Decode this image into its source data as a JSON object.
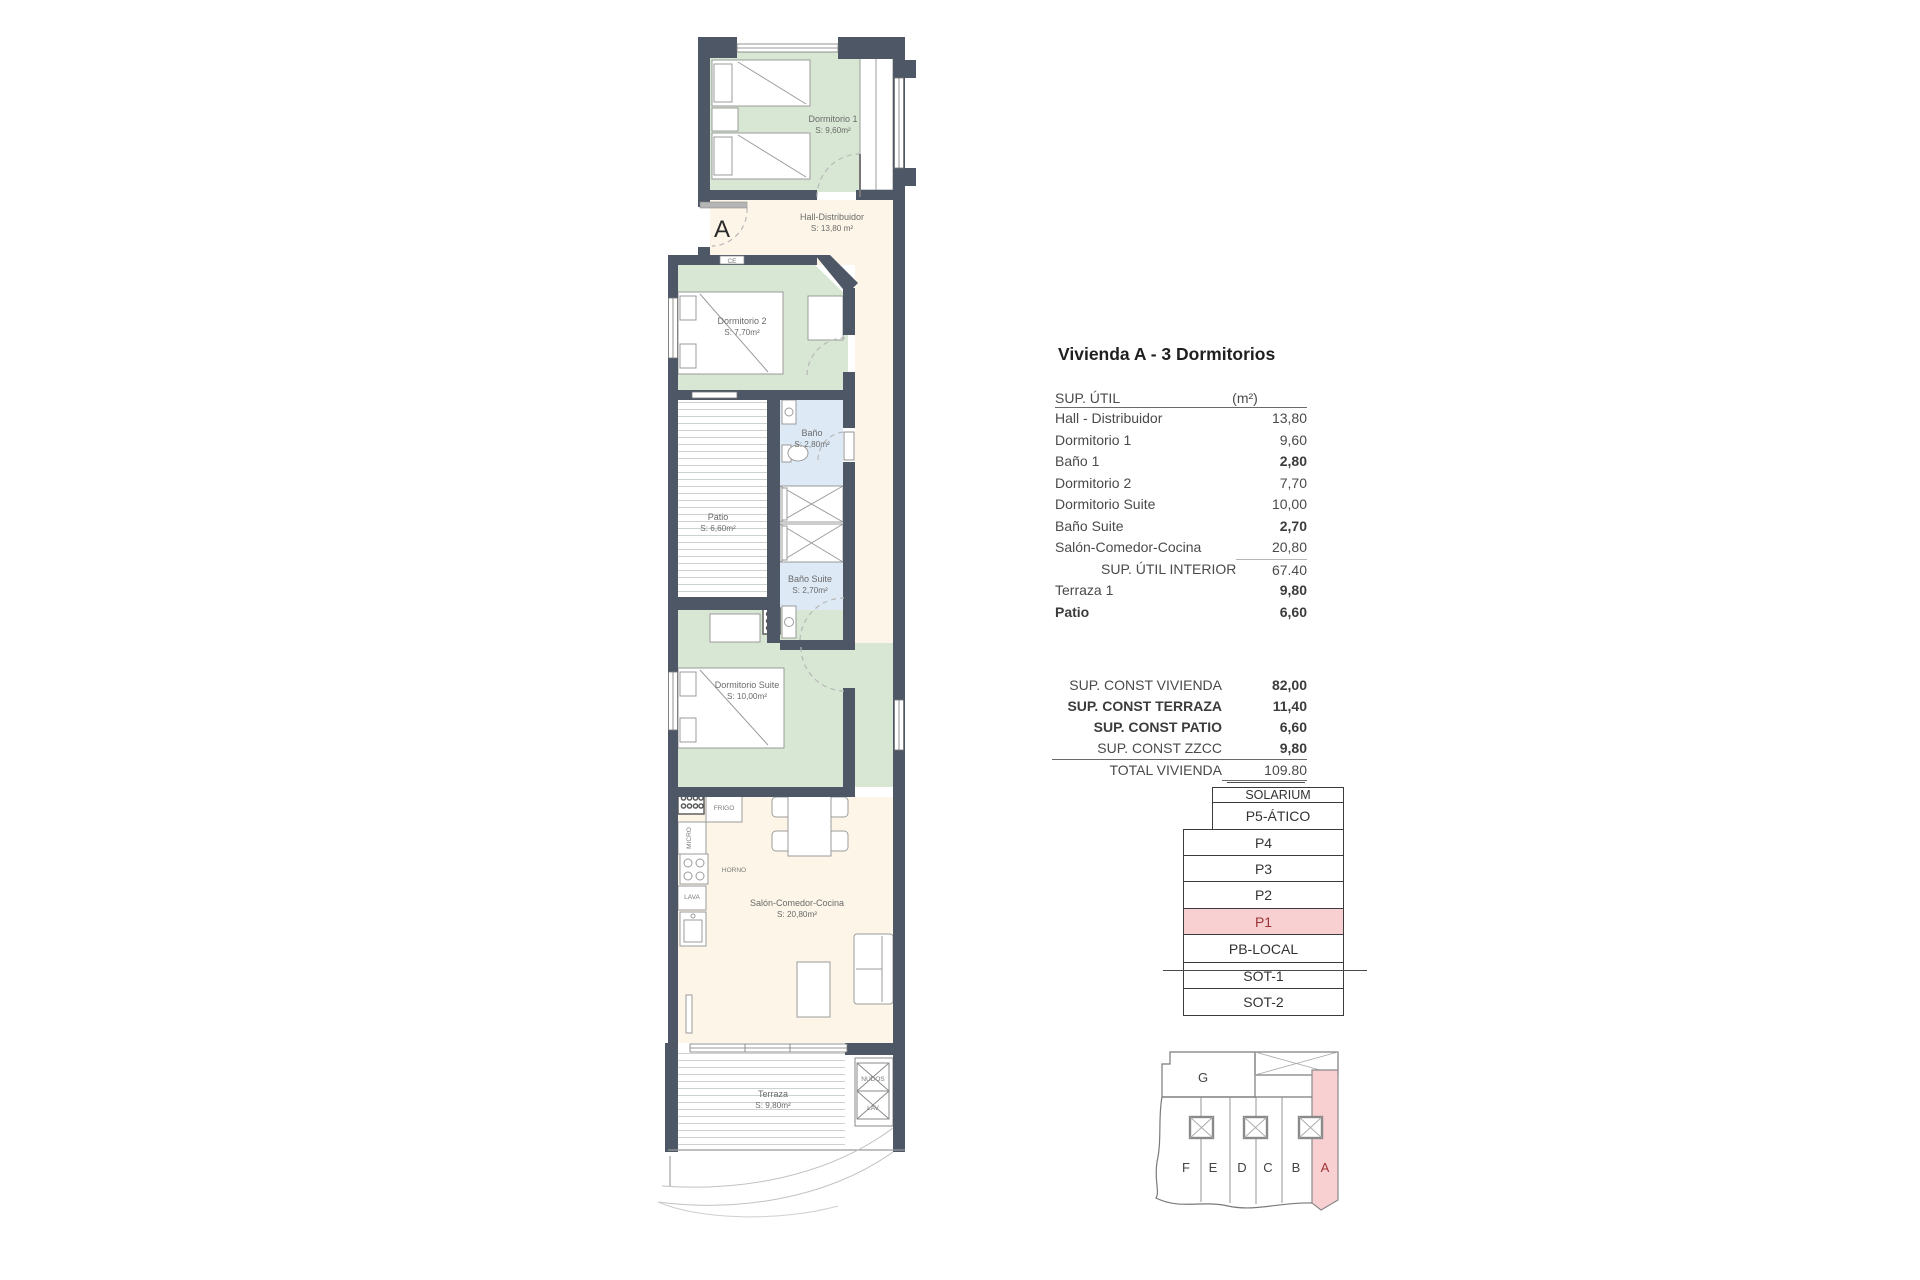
{
  "colors": {
    "wall": "#4d5765",
    "room_green": "#d7e7d3",
    "hall_cream": "#fdf6e8",
    "bath_blue": "#dde9f5",
    "highlight_pink": "#f8d0d2",
    "highlight_red": "#9c3434"
  },
  "floorplan": {
    "entry": {
      "label": "A"
    },
    "rooms": [
      {
        "id": "dormitorio-1",
        "name": "Dormitorio 1",
        "area": "S: 9,60m²",
        "x": 833,
        "y": 122
      },
      {
        "id": "hall-distribuidor",
        "name": "Hall-Distribuidor",
        "area": "S: 13,80 m²",
        "x": 832,
        "y": 220
      },
      {
        "id": "dormitorio-2",
        "name": "Dormitorio 2",
        "area": "S: 7,70m²",
        "x": 742,
        "y": 324
      },
      {
        "id": "bano-1",
        "name": "Baño",
        "area": "S: 2,80m²",
        "x": 812,
        "y": 436
      },
      {
        "id": "patio",
        "name": "Patio",
        "area": "S: 6,60m²",
        "x": 718,
        "y": 520
      },
      {
        "id": "bano-suite",
        "name": "Baño Suite",
        "area": "S: 2,70m²",
        "x": 810,
        "y": 582
      },
      {
        "id": "dormitorio-suite",
        "name": "Dormitorio Suite",
        "area": "S: 10,00m²",
        "x": 747,
        "y": 688
      },
      {
        "id": "salon-comedor-cocina",
        "name": "Salón-Comedor-Cocina",
        "area": "S: 20,80m²",
        "x": 797,
        "y": 906
      },
      {
        "id": "terraza",
        "name": "Terraza",
        "area": "S: 9,80m²",
        "x": 773,
        "y": 1097
      }
    ],
    "appliances": [
      {
        "id": "frigo",
        "label": "FRIGO",
        "x": 724,
        "y": 810
      },
      {
        "id": "micro",
        "label": "MICRO",
        "x": 691,
        "y": 838,
        "rotate": -90
      },
      {
        "id": "horno",
        "label": "HORNO",
        "x": 734,
        "y": 872
      },
      {
        "id": "lava",
        "label": "LAVA",
        "x": 692,
        "y": 899
      },
      {
        "id": "nudos",
        "label": "NUDOS",
        "x": 873,
        "y": 1081
      },
      {
        "id": "lav",
        "label": "LAV",
        "x": 873,
        "y": 1110
      },
      {
        "id": "ce",
        "label": "CE",
        "x": 732,
        "y": 263
      }
    ]
  },
  "summary": {
    "title": "Vivienda A - 3 Dormitorios",
    "sup_util": {
      "header": {
        "label": "SUP. ÚTIL",
        "unit": "(m²)"
      },
      "rows": [
        {
          "label": "Hall - Distribuidor",
          "value": "13,80"
        },
        {
          "label": "Dormitorio 1",
          "value": "9,60"
        },
        {
          "label": "Baño 1",
          "value": "2,80",
          "bold_value": true
        },
        {
          "label": "Dormitorio 2",
          "value": "7,70"
        },
        {
          "label": "Dormitorio Suite",
          "value": "10,00"
        },
        {
          "label": "Baño Suite",
          "value": "2,70",
          "bold_value": true
        },
        {
          "label": "Salón-Comedor-Cocina",
          "value": "20,80"
        },
        {
          "label": "SUP. ÚTIL INTERIOR",
          "value": "67.40",
          "subtotal": true
        },
        {
          "label": "Terraza 1",
          "value": "9,80",
          "bold_value": true
        },
        {
          "label": "Patio",
          "value": "6,60",
          "bold_label": true,
          "bold_value": true
        }
      ]
    },
    "sup_const": {
      "rows": [
        {
          "label": "SUP. CONST VIVIENDA",
          "value": "82,00",
          "bold_value": true
        },
        {
          "label": "SUP. CONST TERRAZA",
          "value": "11,40",
          "bold_label": true,
          "bold_value": true
        },
        {
          "label": "SUP. CONST PATIO",
          "value": "6,60",
          "bold_label": true,
          "bold_value": true
        },
        {
          "label": "SUP. CONST ZZCC",
          "value": "9,80",
          "bold_value": true
        },
        {
          "label": "TOTAL VIVIENDA",
          "value": "109.80",
          "total": true
        }
      ]
    }
  },
  "levels": {
    "items": [
      {
        "label": "SOLARIUM",
        "narrow": true,
        "small": true
      },
      {
        "label": "P5-ÁTICO",
        "narrow": true
      },
      {
        "label": "P4"
      },
      {
        "label": "P3"
      },
      {
        "label": "P2"
      },
      {
        "label": "P1",
        "highlight": true
      },
      {
        "label": "PB-LOCAL"
      },
      {
        "label": "SOT-1"
      },
      {
        "label": "SOT-2"
      }
    ]
  },
  "keyplan": {
    "g_label": "G",
    "units": [
      {
        "letter": "F",
        "x": 46
      },
      {
        "letter": "E",
        "x": 73
      },
      {
        "letter": "D",
        "x": 102
      },
      {
        "letter": "C",
        "x": 128
      },
      {
        "letter": "B",
        "x": 156
      },
      {
        "letter": "A",
        "x": 185,
        "highlight": true
      }
    ]
  }
}
